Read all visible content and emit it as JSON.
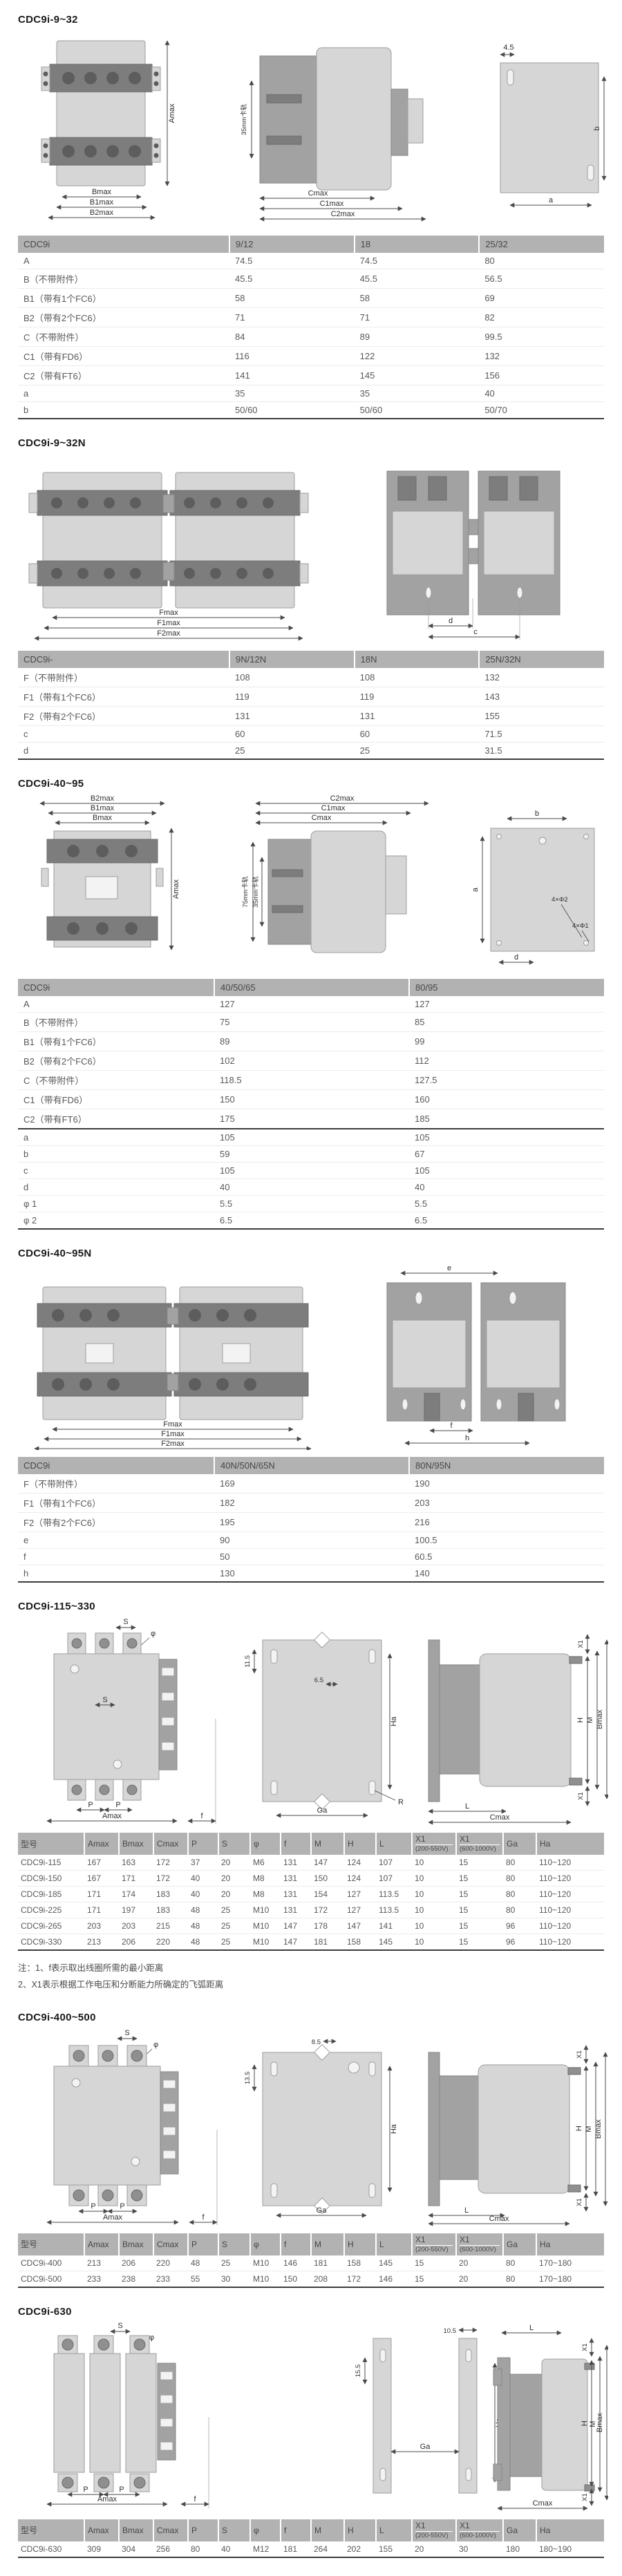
{
  "page_title": "CDC9i outline and mounting dimensions",
  "colors": {
    "header_bg": "#b2b2b2",
    "table_border": "#3c3c3c",
    "drawing_light": "#d6d6d6",
    "drawing_dark": "#7d7d7d"
  },
  "sections": [
    {
      "title": "CDC9i-9~32",
      "dims": {
        "front": [
          "Amax",
          "Bmax",
          "B1max",
          "B2max"
        ],
        "side": [
          "35mm卡轨",
          "Cmax",
          "C1max",
          "C2max"
        ],
        "plate": [
          "4.5",
          "b",
          "a"
        ]
      },
      "table": {
        "headers": [
          "CDC9i",
          "9/12",
          "18",
          "25/32"
        ],
        "rows": [
          [
            "A",
            "74.5",
            "74.5",
            "80"
          ],
          [
            "B（不带附件）",
            "45.5",
            "45.5",
            "56.5"
          ],
          [
            "B1（带有1个FC6）",
            "58",
            "58",
            "69"
          ],
          [
            "B2（带有2个FC6）",
            "71",
            "71",
            "82"
          ],
          [
            "C（不带附件）",
            "84",
            "89",
            "99.5"
          ],
          [
            "C1（带有FD6）",
            "116",
            "122",
            "132"
          ],
          [
            "C2（带有FT6）",
            "141",
            "145",
            "156"
          ],
          [
            "a",
            "35",
            "35",
            "40"
          ],
          [
            "b",
            "50/60",
            "50/60",
            "50/70"
          ]
        ]
      }
    },
    {
      "title": "CDC9i-9~32N",
      "dims": {
        "front": [
          "Fmax",
          "F1max",
          "F2max"
        ],
        "top": [
          "d",
          "c"
        ]
      },
      "table": {
        "headers": [
          "CDC9i-",
          "9N/12N",
          "18N",
          "25N/32N"
        ],
        "rows": [
          [
            "F（不带附件）",
            "108",
            "108",
            "132"
          ],
          [
            "F1（带有1个FC6）",
            "119",
            "119",
            "143"
          ],
          [
            "F2（带有2个FC6）",
            "131",
            "131",
            "155"
          ],
          [
            "c",
            "60",
            "60",
            "71.5"
          ],
          [
            "d",
            "25",
            "25",
            "31.5"
          ]
        ]
      }
    },
    {
      "title": "CDC9i-40~95",
      "dims": {
        "front": [
          "B2max",
          "B1max",
          "Bmax",
          "Amax"
        ],
        "side": [
          "C2max",
          "C1max",
          "Cmax",
          "75mm卡轨",
          "35mm卡轨"
        ],
        "plate": [
          "b",
          "a",
          "4×Φ2",
          "4×Φ1",
          "d"
        ]
      },
      "table": {
        "headers": [
          "CDC9i",
          "40/50/65",
          "80/95"
        ],
        "divider_before": 7,
        "rows": [
          [
            "A",
            "127",
            "127"
          ],
          [
            "B（不带附件）",
            "75",
            "85"
          ],
          [
            "B1（带有1个FC6）",
            "89",
            "99"
          ],
          [
            "B2（带有2个FC6）",
            "102",
            "112"
          ],
          [
            "C（不带附件）",
            "118.5",
            "127.5"
          ],
          [
            "C1（带有FD6）",
            "150",
            "160"
          ],
          [
            "C2（带有FT6）",
            "175",
            "185"
          ],
          [
            "a",
            "105",
            "105"
          ],
          [
            "b",
            "59",
            "67"
          ],
          [
            "c",
            "105",
            "105"
          ],
          [
            "d",
            "40",
            "40"
          ],
          [
            "φ 1",
            "5.5",
            "5.5"
          ],
          [
            "φ 2",
            "6.5",
            "6.5"
          ]
        ]
      }
    },
    {
      "title": "CDC9i-40~95N",
      "dims": {
        "front": [
          "Fmax",
          "F1max",
          "F2max"
        ],
        "top": [
          "e",
          "f",
          "h"
        ]
      },
      "table": {
        "headers": [
          "CDC9i",
          "40N/50N/65N",
          "80N/95N"
        ],
        "rows": [
          [
            "F（不带附件）",
            "169",
            "190"
          ],
          [
            "F1（带有1个FC6）",
            "182",
            "203"
          ],
          [
            "F2（带有2个FC6）",
            "195",
            "216"
          ],
          [
            "e",
            "90",
            "100.5"
          ],
          [
            "f",
            "50",
            "60.5"
          ],
          [
            "h",
            "130",
            "140"
          ]
        ]
      }
    },
    {
      "title": "CDC9i-115~330",
      "dims": {
        "front": [
          "S",
          "φ",
          "S",
          "P",
          "P",
          "Amax",
          "f"
        ],
        "plate": [
          "11.5",
          "6.5",
          "Ha",
          "Ga",
          "R"
        ],
        "side": [
          "X1",
          "H",
          "M",
          "Bmax",
          "X1",
          "L",
          "Cmax"
        ]
      },
      "table": {
        "headers": [
          "型号",
          "Amax",
          "Bmax",
          "Cmax",
          "P",
          "S",
          "φ",
          "f",
          "M",
          "H",
          "L",
          {
            "t": "X1",
            "s": "(200-550V)"
          },
          {
            "t": "X1",
            "s": "(600-1000V)"
          },
          "Ga",
          "Ha"
        ],
        "rows": [
          [
            "CDC9i-115",
            "167",
            "163",
            "172",
            "37",
            "20",
            "M6",
            "131",
            "147",
            "124",
            "107",
            "10",
            "15",
            "80",
            "110~120"
          ],
          [
            "CDC9i-150",
            "167",
            "171",
            "172",
            "40",
            "20",
            "M8",
            "131",
            "150",
            "124",
            "107",
            "10",
            "15",
            "80",
            "110~120"
          ],
          [
            "CDC9i-185",
            "171",
            "174",
            "183",
            "40",
            "20",
            "M8",
            "131",
            "154",
            "127",
            "113.5",
            "10",
            "15",
            "80",
            "110~120"
          ],
          [
            "CDC9i-225",
            "171",
            "197",
            "183",
            "48",
            "25",
            "M10",
            "131",
            "172",
            "127",
            "113.5",
            "10",
            "15",
            "80",
            "110~120"
          ],
          [
            "CDC9i-265",
            "203",
            "203",
            "215",
            "48",
            "25",
            "M10",
            "147",
            "178",
            "147",
            "141",
            "10",
            "15",
            "96",
            "110~120"
          ],
          [
            "CDC9i-330",
            "213",
            "206",
            "220",
            "48",
            "25",
            "M10",
            "147",
            "181",
            "158",
            "145",
            "10",
            "15",
            "96",
            "110~120"
          ]
        ]
      },
      "notes": [
        "注：1、f表示取出线圈所需的最小距离",
        "2、X1表示根据工作电压和分断能力所确定的飞弧距离"
      ]
    },
    {
      "title": "CDC9i-400~500",
      "dims": {
        "front": [
          "S",
          "φ",
          "P",
          "P",
          "Amax",
          "f"
        ],
        "plate": [
          "8.5",
          "13.5",
          "Ha",
          "Ga"
        ],
        "side": [
          "X1",
          "H",
          "M",
          "Bmax",
          "X1",
          "L",
          "Cmax"
        ]
      },
      "table": {
        "headers": [
          "型号",
          "Amax",
          "Bmax",
          "Cmax",
          "P",
          "S",
          "φ",
          "f",
          "M",
          "H",
          "L",
          {
            "t": "X1",
            "s": "(200-550V)"
          },
          {
            "t": "X1",
            "s": "(600-1000V)"
          },
          "Ga",
          "Ha"
        ],
        "rows": [
          [
            "CDC9i-400",
            "213",
            "206",
            "220",
            "48",
            "25",
            "M10",
            "146",
            "181",
            "158",
            "145",
            "15",
            "20",
            "80",
            "170~180"
          ],
          [
            "CDC9i-500",
            "233",
            "238",
            "233",
            "55",
            "30",
            "M10",
            "150",
            "208",
            "172",
            "146",
            "15",
            "20",
            "80",
            "170~180"
          ]
        ]
      }
    },
    {
      "title": "CDC9i-630",
      "dims": {
        "front": [
          "S",
          "φ",
          "P",
          "P",
          "Amax",
          "f"
        ],
        "rails": [
          "10.5",
          "15.5",
          "Ha",
          "Ga"
        ],
        "side": [
          "L",
          "X1",
          "H",
          "M",
          "Bmax",
          "X1",
          "Cmax"
        ]
      },
      "table": {
        "headers": [
          "型号",
          "Amax",
          "Bmax",
          "Cmax",
          "P",
          "S",
          "φ",
          "f",
          "M",
          "H",
          "L",
          {
            "t": "X1",
            "s": "(200-550V)"
          },
          {
            "t": "X1",
            "s": "(600-1000V)"
          },
          "Ga",
          "Ha"
        ],
        "rows": [
          [
            "CDC9i-630",
            "309",
            "304",
            "256",
            "80",
            "40",
            "M12",
            "181",
            "264",
            "202",
            "155",
            "20",
            "30",
            "180",
            "180~190"
          ]
        ]
      }
    }
  ]
}
